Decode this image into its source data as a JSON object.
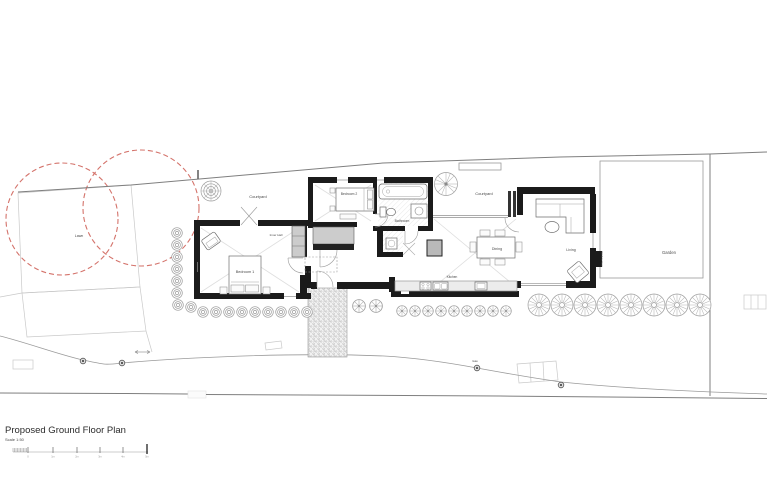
{
  "drawing": {
    "title": "Proposed Ground Floor Plan",
    "scale_label": "Scale 1:50",
    "rooms": {
      "bedroom1": "Bedroom 1",
      "bedroom2": "Bedroom 2",
      "bathroom": "Bathroom",
      "inner_hall": "Inner Hall",
      "kitchen": "Kitchen",
      "dining": "Dining",
      "living": "Living",
      "courtyard_west": "Courtyard",
      "courtyard_east": "Courtyard",
      "garden": "Garden",
      "lawn": "Lawn"
    },
    "annotations": {
      "window_seat": "Window Seat",
      "gate": "Gate"
    },
    "scale_bar": {
      "tick_labels": [
        "0",
        "1m",
        "2m",
        "3m",
        "4m",
        "5m"
      ]
    },
    "colors": {
      "wall": "#1b1b1b",
      "boundary_line": "#7f7f7f",
      "faint_line": "#c9c9c9",
      "tree_canopy_red": "#d4736b",
      "label_text": "#4a4a4a"
    }
  }
}
